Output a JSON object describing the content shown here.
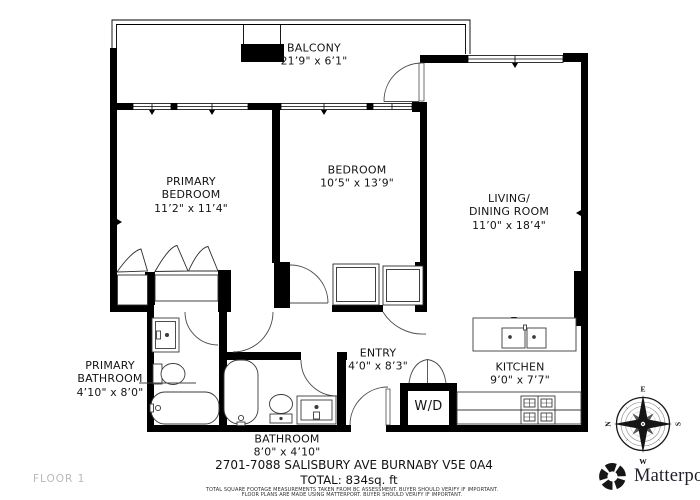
{
  "floor": {
    "label": "FLOOR 1"
  },
  "rooms": {
    "balcony": {
      "name": "BALCONY",
      "dims": "21’9\" x 6’1\""
    },
    "primary_bedroom": {
      "name": "PRIMARY",
      "name2": "BEDROOM",
      "dims": "11’2\" x 11’4\""
    },
    "bedroom": {
      "name": "BEDROOM",
      "dims": "10’5\" x 13’9\""
    },
    "living_dining": {
      "name": "LIVING/",
      "name2": "DINING ROOM",
      "dims": "11’0\" x 18’4\""
    },
    "primary_bathroom": {
      "name": "PRIMARY",
      "name2": "BATHROOM",
      "dims": "4’10\" x 8’0\""
    },
    "bathroom": {
      "name": "BATHROOM",
      "dims": "8’0\" x 4’10\""
    },
    "entry": {
      "name": "ENTRY",
      "dims": "4’0\" x 8’3\""
    },
    "kitchen": {
      "name": "KITCHEN",
      "dims": "9’0\" x 7’7\""
    },
    "washer_dryer": {
      "name": "W/D"
    }
  },
  "footer": {
    "address": "2701-7088 SALISBURY AVE BURNABY V5E 0A4",
    "total": "TOTAL: 834sq. ft",
    "disclaimer_line1": "TOTAL SQUARE FOOTAGE MEASUREMENTS TAKEN FROM BC ASSESSMENT. BUYER SHOULD VERIFY IF IMPORTANT.",
    "disclaimer_line2": "FLOOR PLANS ARE MADE USING MATTERPORT. BUYER SHOULD VERIFY IF IMPORTANT."
  },
  "branding": {
    "name": "Matterport",
    "mark": "®"
  },
  "compass": {
    "east": "E",
    "west": "W",
    "north": "N",
    "south": "S"
  },
  "colors": {
    "wall": "#000000",
    "label_text": "#141414",
    "floor_label": "#b9b9b9",
    "fixture_line": "#3a3a3a"
  }
}
